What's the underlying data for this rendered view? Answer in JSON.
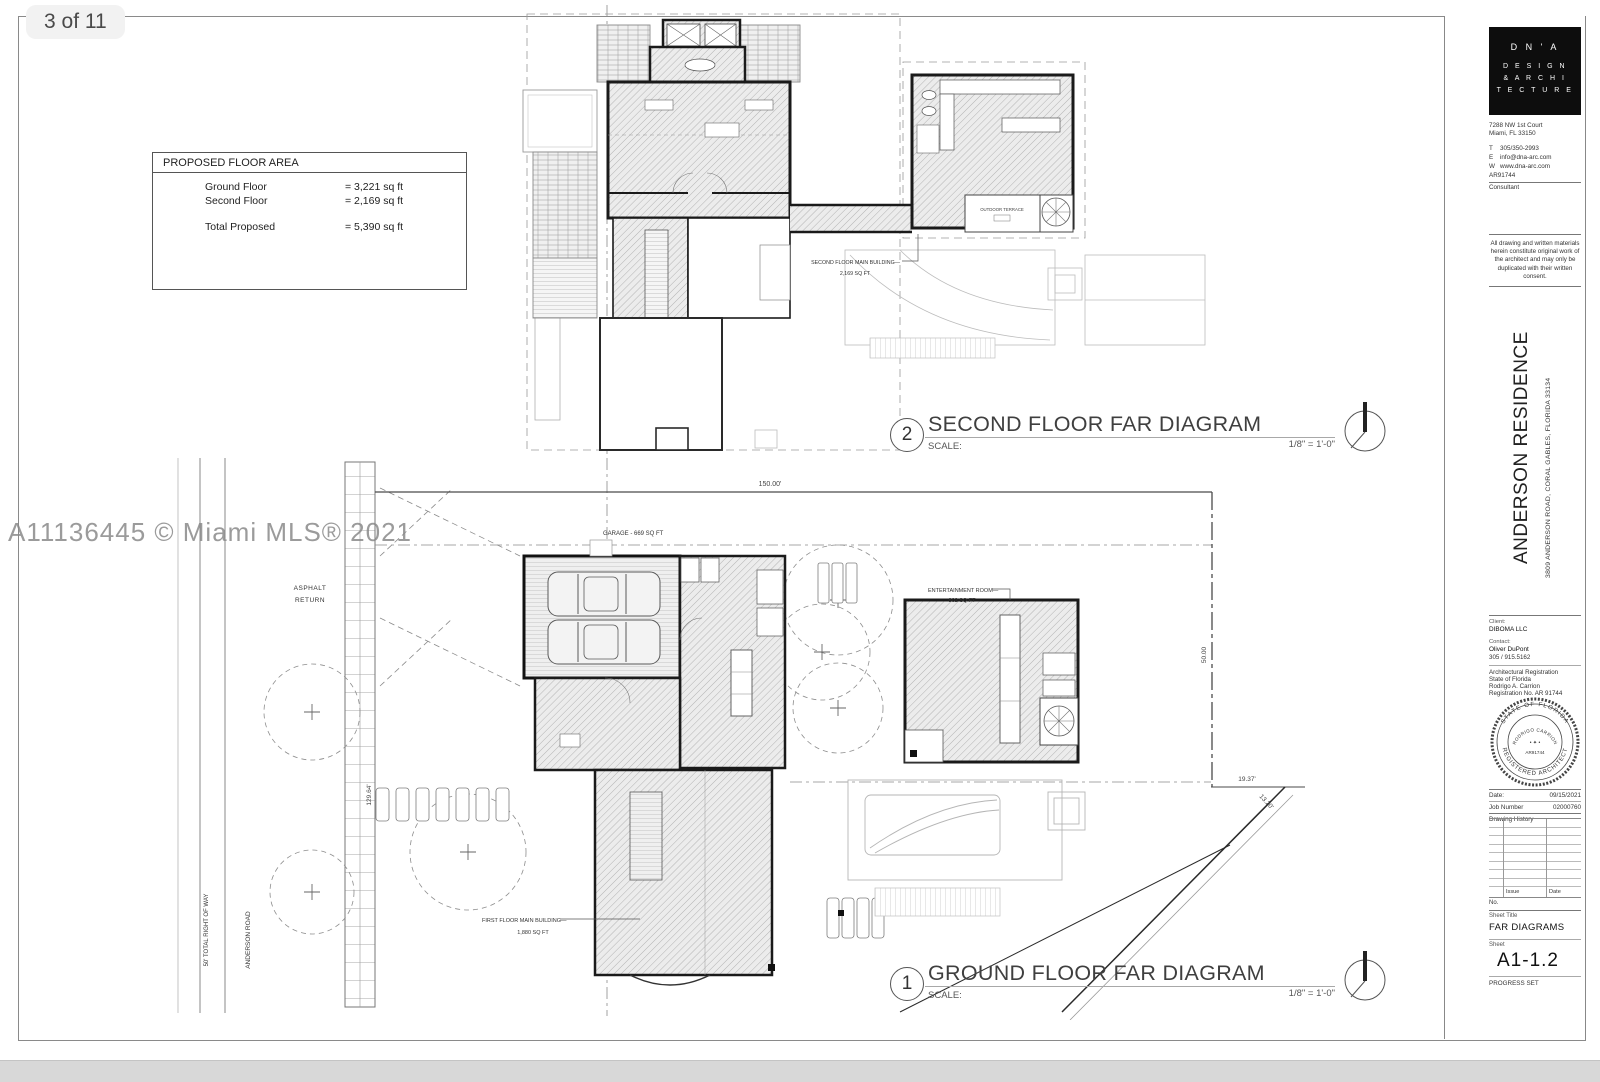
{
  "page": {
    "badge": "3 of 11",
    "watermark": "A11136445 © Miami MLS® 2021"
  },
  "colors": {
    "page_bg": "#ffffff",
    "bottom_bar": "#d8d8d8",
    "badge_bg": "#f2f2f2",
    "line": "#1a1a1a",
    "watermark": "#8a8a8a"
  },
  "floor_area": {
    "title": "PROPOSED FLOOR AREA",
    "rows": [
      {
        "label": "Ground Floor",
        "value": "= 3,221 sq ft"
      },
      {
        "label": "Second Floor",
        "value": "= 2,169 sq ft"
      },
      {
        "label": "Total Proposed",
        "value": "= 5,390 sq ft"
      }
    ]
  },
  "sf": {
    "number": "2",
    "title": "SECOND FLOOR FAR DIAGRAM",
    "scale_label": "SCALE:",
    "scale_value": "1/8\" = 1'-0\"",
    "label_line1": "SECOND FLOOR MAIN BUILDING—",
    "label_line2": "2,169 SQ FT",
    "terrace": "OUTDOOR TERRACE"
  },
  "gf": {
    "number": "1",
    "title": "GROUND FLOOR FAR DIAGRAM",
    "scale_label": "SCALE:",
    "scale_value": "1/8\" = 1'-0\"",
    "garage_label": "GARAGE - 669 SQ FT",
    "ent_line1": "ENTERTAINMENT ROOM—",
    "ent_line2": "802 SQ FT",
    "main_line1": "FIRST FLOOR MAIN BUILDING—",
    "main_line2": "1,880 SQ FT",
    "asphalt_line1": "ASPHALT",
    "asphalt_line2": "RETURN",
    "row_label": "50' TOTAL RIGHT OF WAY",
    "road_label": "ANDERSON ROAD",
    "dim_top": "150.00'",
    "dim_right": "50.00",
    "dim_right2": "19.37'",
    "dim_diag": "13.20'",
    "dim_left": "129.64'"
  },
  "tb": {
    "logo1": "D N ' A",
    "logo2": "D E S I G N",
    "logo3": "& A R C H I",
    "logo4": "T E C T U R E",
    "addr1": "7288 NW 1st Court",
    "addr2": "Miami, FL 33150",
    "t_label": "T",
    "t": "305/350-2993",
    "e_label": "E",
    "e": "info@dna-arc.com",
    "w_label": "W",
    "w": "www.dna-arc.com",
    "reg": "AR91744",
    "consultant": "Consultant",
    "copyright": "All drawing and written materials herein constitute original work of the architect and may only be duplicated with their written consent.",
    "project": "ANDERSON RESIDENCE",
    "project_addr": "3809 ANDERSON ROAD, CORAL GABLES, FLORIDA 33134",
    "client_label": "Client:",
    "client": "DIBOMA LLC",
    "contact_label": "Contact:",
    "contact": "Oliver DuPont",
    "contact_phone": "305 / 915.5162",
    "areg1": "Architectural Registration",
    "areg2": "State of Florida",
    "areg3": "Rodrigo A. Carrion",
    "areg4": "Registration No. AR 91744",
    "seal_top": "STATE OF FLORIDA",
    "seal_bottom": "REGISTERED ARCHITECT",
    "seal_name": "RODRIGO CARRION",
    "seal_no": "AR91744",
    "date_label": "Date:",
    "date": "09/15/2021",
    "job_label": "Job Number",
    "job": "02000760",
    "history_label": "Drawing History",
    "issue": "Issue",
    "hist_date": "Date",
    "no_label": "No.",
    "sheet_title_label": "Sheet Title",
    "sheet_title": "FAR DIAGRAMS",
    "sheet_label": "Sheet",
    "sheet": "A1-1.2",
    "set": "PROGRESS SET"
  }
}
